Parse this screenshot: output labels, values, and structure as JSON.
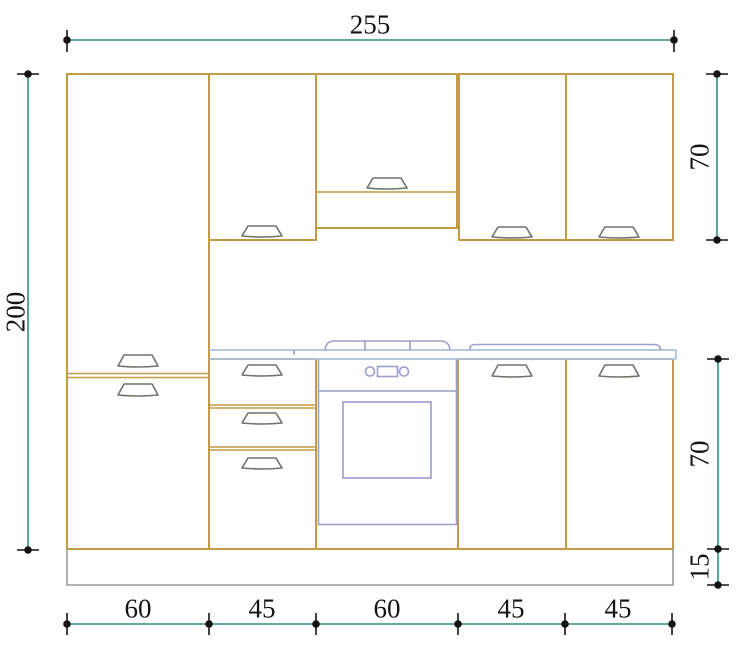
{
  "drawing": {
    "title": "kitchen cabinet elevation technical drawing",
    "colors": {
      "cabinet": "#C29B45",
      "dimension": "#2F8F7E",
      "counter": "#A9C3DE",
      "appliance": "#9D9DC9",
      "handle": "#6E746A",
      "plinth": "#9A9A9A",
      "marker": "#141414"
    },
    "dimensions": {
      "total_width": {
        "label": "255"
      },
      "total_height": {
        "label": "200"
      },
      "upper_cabinet_height": {
        "label": "70"
      },
      "base_cabinet_height": {
        "label": "70"
      },
      "plinth_height": {
        "label": "15"
      },
      "bottom_widths": {
        "labels": [
          "60",
          "45",
          "60",
          "45",
          "45"
        ]
      }
    }
  }
}
